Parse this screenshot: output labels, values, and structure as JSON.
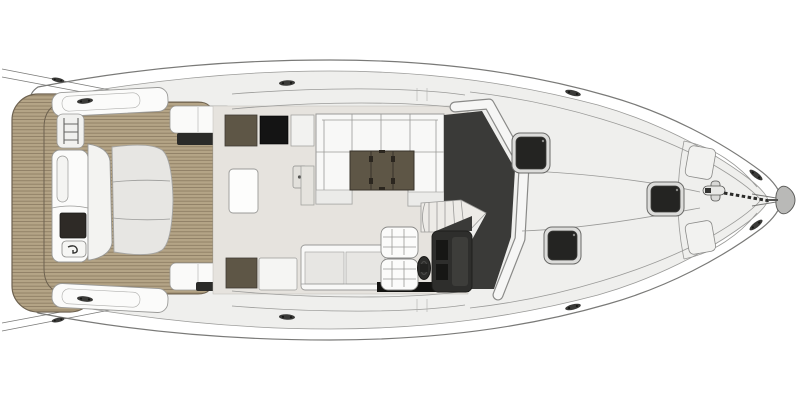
{
  "figure": {
    "kind": "yacht-deck-plan-top-view",
    "orientation": "bow-right-stern-left",
    "parts": {
      "hatch_count": 3,
      "helm_seat_count": 2,
      "cleat_count": 8
    }
  },
  "colors": {
    "background": "#ffffff",
    "hull_fill": "#ffffff",
    "hull_line": "#7a7a78",
    "deck_fill": "#efefed",
    "walkway_fill": "#f6f6f5",
    "cockpit_floor": "#e6e3de",
    "teak": "#b4a486",
    "teak_line": "#84745a",
    "teak_edge": "#6e6250",
    "dark_glass": "#3a3a38",
    "console_dark": "#2e2e2c",
    "module_olive": "#5e5646",
    "module_black": "#141414",
    "hatch_dark": "#242422",
    "hatch_frame": "#dcdcda",
    "seat_white": "#f8f8f7",
    "seat_gray": "#e7e6e3",
    "metal_gray": "#b9b9b7",
    "black_detail": "#121210"
  }
}
